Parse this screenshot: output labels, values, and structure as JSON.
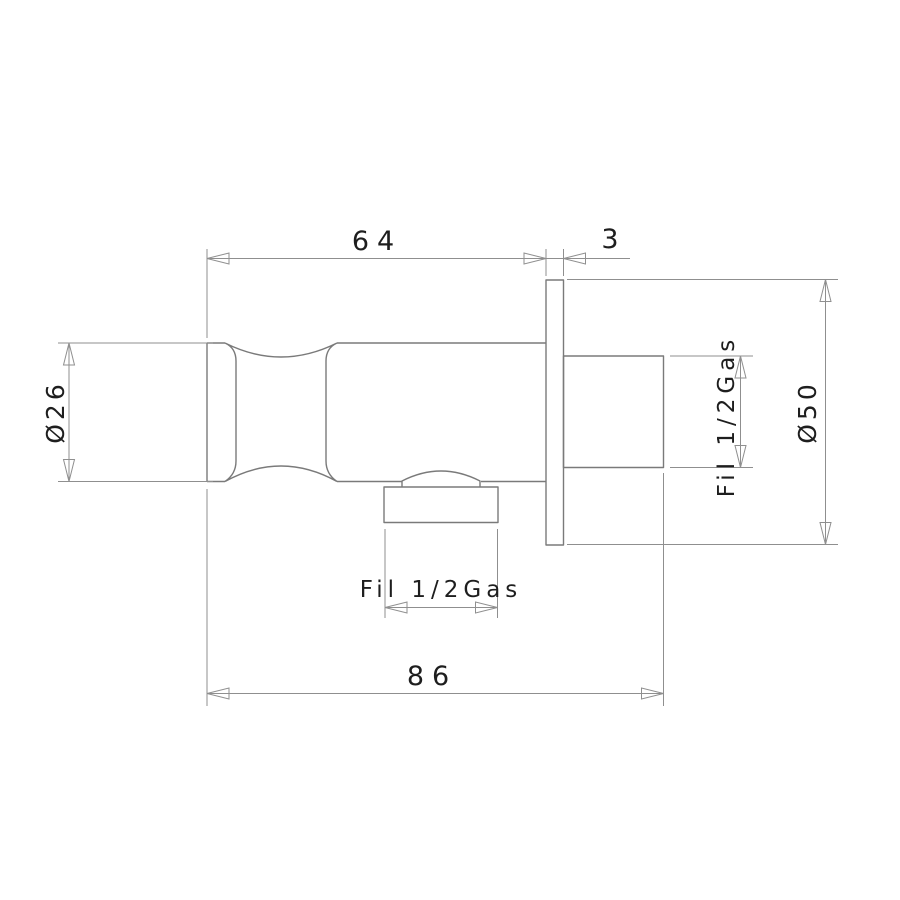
{
  "drawing": {
    "kind": "dimensioned technical drawing of a wall-mounted water outlet elbow",
    "dimensions": {
      "body_length": "64",
      "flange_thickness": "3",
      "overall_length": "86",
      "body_diameter": "Ø26",
      "flange_diameter": "Ø50",
      "outlet_thread": "Fil 1/2Gas",
      "inlet_thread": "Fil 1/2Gas"
    },
    "colors": {
      "background": "#ffffff",
      "part_line": "#7a7a7a",
      "dimension_line": "#8f8f8f",
      "text": "#1e1e1e"
    }
  }
}
